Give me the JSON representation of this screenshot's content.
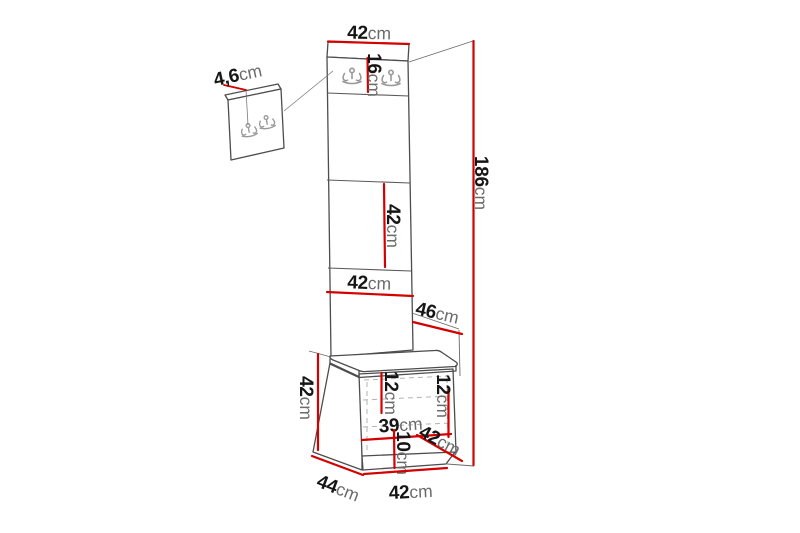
{
  "diagram": {
    "title": "hallway-furniture-dimension-diagram",
    "background": "#ffffff",
    "colors": {
      "dimension_line": "#d40000",
      "outline": "#4d4d4d",
      "dashed_hidden_edges": "#b3b3b3",
      "number_text": "#161616",
      "unit_text": "#6b6b6b",
      "hook": "#9a9a9a"
    },
    "dimensions": {
      "panel_width_top": {
        "value": "42",
        "unit": "cm"
      },
      "hook_panel_height": {
        "value": "16",
        "unit": "cm"
      },
      "wall_panel_depth": {
        "value": "4,6",
        "unit": "cm"
      },
      "total_height": {
        "value": "186",
        "unit": "cm"
      },
      "panel_section_height": {
        "value": "42",
        "unit": "cm"
      },
      "panel_width_lower": {
        "value": "42",
        "unit": "cm"
      },
      "bench_area_depth": {
        "value": "46",
        "unit": "cm"
      },
      "bench_height": {
        "value": "42",
        "unit": "cm"
      },
      "compartment_height_left": {
        "value": "12",
        "unit": "cm"
      },
      "compartment_height_right": {
        "value": "12",
        "unit": "cm"
      },
      "interior_width": {
        "value": "39",
        "unit": "cm"
      },
      "plinth_height": {
        "value": "10",
        "unit": "cm"
      },
      "seat_inner_depth": {
        "value": "42",
        "unit": "cm"
      },
      "bench_depth": {
        "value": "44",
        "unit": "cm"
      },
      "bench_width": {
        "value": "42",
        "unit": "cm"
      }
    }
  }
}
